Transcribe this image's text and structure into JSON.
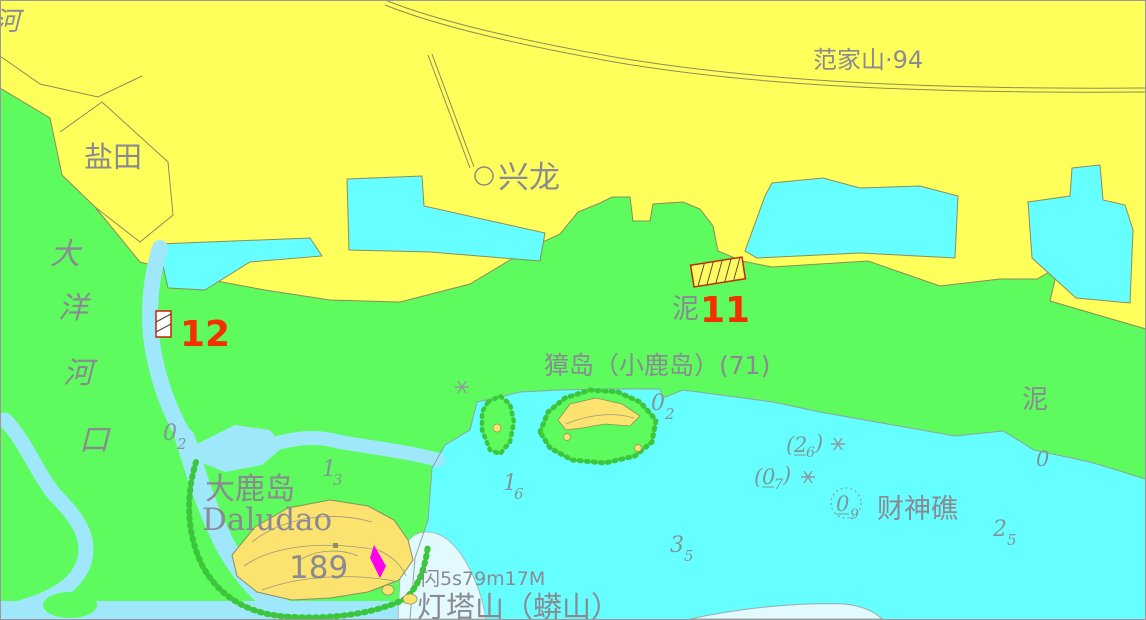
{
  "colors": {
    "land_yellow": "#FFFF5C",
    "tidal_green": "#5DFB5D",
    "sea_cyan": "#66FFFF",
    "channel_blue": "#9FE8FC",
    "shoal_pale": "#E2FAFE",
    "island_yellow": "#FCE26E",
    "label_gray": "#8A8A92",
    "sounding_gray": "#7E9696",
    "marker_red": "#F53000",
    "light_magenta": "#FF00EE",
    "boundary_line": "#8C8C5A"
  },
  "labels": {
    "hill_top_right": "范家山·94",
    "salt_field": "盐田",
    "village": "兴龙",
    "river_name_partial": "河",
    "estuary_vertical": [
      "大",
      "洋",
      "河",
      "口"
    ],
    "island_main": "獐岛（小鹿岛）(71)",
    "mud_seabed_left": "泥",
    "mud_seabed_right": "泥",
    "daludao_cn": "大鹿岛",
    "daludao_en": "Daludao",
    "daludao_elevation": "189",
    "light_characteristic": "闪5s79m17M",
    "lighthouse_hill": "灯塔山（蟒山）",
    "reef_name": "财神礁"
  },
  "anchorages": {
    "berth_11": "11",
    "berth_12": "12"
  },
  "soundings": [
    {
      "id": "estuary-channel",
      "main": "0",
      "sub": "2"
    },
    {
      "id": "daludao-channel",
      "main": "1",
      "sub": "3"
    },
    {
      "id": "inshore",
      "main": "1",
      "sub": "6"
    },
    {
      "id": "zhangdao-east",
      "main": "0",
      "sub": "2"
    },
    {
      "id": "south-fairway",
      "main": "3",
      "sub": "5"
    },
    {
      "id": "east-fairway",
      "main": "2",
      "sub": "5"
    },
    {
      "id": "zero-contour",
      "main": "0",
      "sub": ""
    }
  ],
  "drying_heights": [
    {
      "open": "(",
      "main": "2",
      "sub": "6",
      "close": ")"
    },
    {
      "open": "(",
      "main": "0",
      "sub": "7",
      "close": ")"
    },
    {
      "open": "",
      "main": "0",
      "sub": "9",
      "close": ""
    }
  ],
  "symbols": {
    "rock_awash": "✳",
    "village_marker": "○",
    "reef_dotted_circle": "◌"
  }
}
